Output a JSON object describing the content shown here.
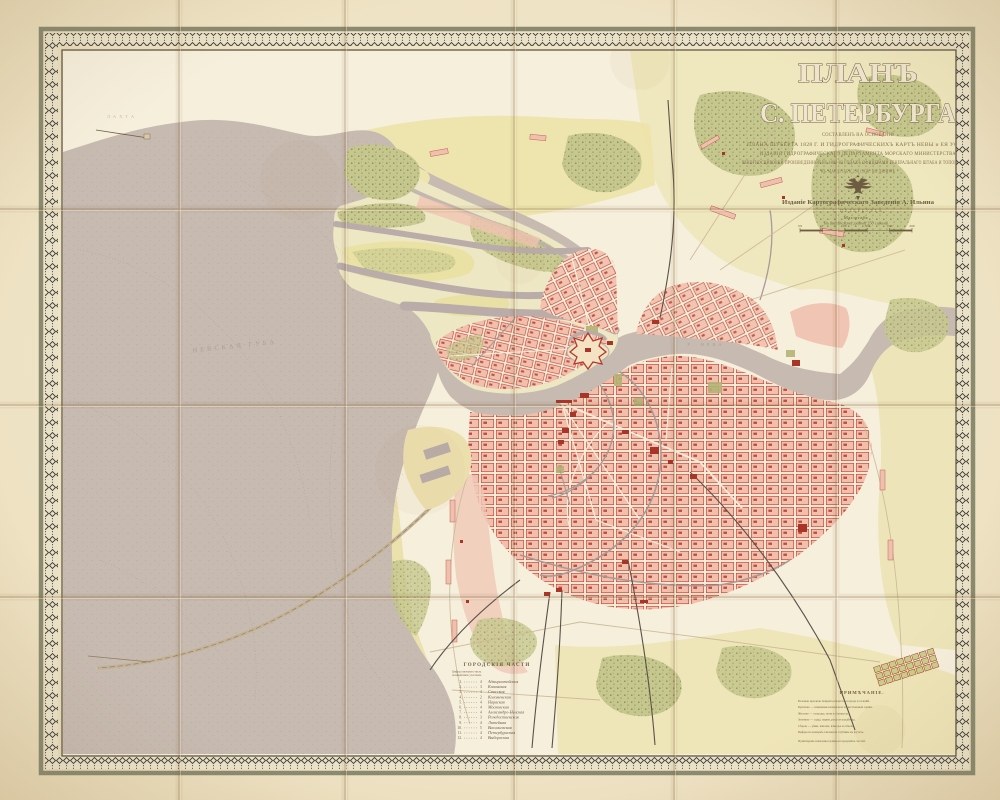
{
  "sheet": {
    "title_line1": "ПЛАНЪ",
    "title_line2": "С. ПЕТЕРБУРГА",
    "subtitle_lines": [
      "СОСТАВЛЕНЪ НА ОСНОВАНІИ",
      "ПЛАНА ШУБЕРТА 1828 Г. И ГИДРОГРАФИЧЕСКИХЪ КАРТЪ НЕВЫ и ЕЯ УСТЬЯ",
      "ИЗДАНІЯ ГИДРОГРАФИЧЕСКАГО ДЕПАРТАМЕНТА МОРСКАГО МИНИСТЕРСТВА",
      "РЕКОГНОСЦИРОВКИ ПРОИЗВЕДЕННОЙ ВЪ 1882-83 ГОДАХЪ ОФИЦЕРАМИ ГЕНЕРАЛЬНАГО ШТАБА И ТОПОГРАФАМИ",
      "ВЪ МАСШТАБѢ 250 САЖ. ВЪ ДЮЙМѢ"
    ],
    "publisher": "Изданіе Картографическаго Заведенія А. Ильина",
    "publisher_city": "С.ПЕТЕРБУРГЪ",
    "scale": {
      "label": "Масштабъ",
      "sublabel": "Въ англійскомъ дюймѣ 250 саженъ",
      "ticks": [
        "500",
        "0",
        "500",
        "1000",
        "1500",
        "2000"
      ]
    },
    "emblem_icon": "double-headed-eagle"
  },
  "map_labels": {
    "gulf": "НЕВСКАЯ ГУБА",
    "lakhta": "ЛАХТА",
    "neva": "Р. НЕВА"
  },
  "legend_districts": {
    "title": "ГОРОДСКІЯ ЧАСТИ",
    "note_line1": "Цифры означаютъ числа",
    "note_line2": "полицейскихъ участковъ",
    "items": [
      {
        "num": "1.",
        "count": "4",
        "name": "Адмиралтейская"
      },
      {
        "num": "2.",
        "count": "3",
        "name": "Казанская"
      },
      {
        "num": "3.",
        "count": "4",
        "name": "Спасская"
      },
      {
        "num": "4.",
        "count": "2",
        "name": "Коломенская"
      },
      {
        "num": "5.",
        "count": "4",
        "name": "Нарвская"
      },
      {
        "num": "6.",
        "count": "4",
        "name": "Московская"
      },
      {
        "num": "7.",
        "count": "4",
        "name": "Александро-Невская"
      },
      {
        "num": "8.",
        "count": "3",
        "name": "Рождественская"
      },
      {
        "num": "9.",
        "count": "4",
        "name": "Литейная"
      },
      {
        "num": "10.",
        "count": "5",
        "name": "Васильевская"
      },
      {
        "num": "11.",
        "count": "4",
        "name": "Петербургская"
      },
      {
        "num": "12.",
        "count": "4",
        "name": "Выборгская"
      }
    ]
  },
  "legend_notes": {
    "title": "ПРИМѢЧАНІЕ.",
    "lines": [
      "Розовою краскою покрыты кварталы города и селеній.",
      "Красною — каменныя казенныя и общественныя зданія.",
      "Желтою — огороды, поля и сѣнокосы.",
      "Зеленою — сады, парки, рощи и кладбища.",
      "Сѣрою — рѣки, каналы, взморье и отмели.",
      "Цифры на взморьѣ означаютъ глубины въ футахъ.",
      "Пунктиромъ показаны границы городскихъ частей."
    ]
  },
  "palette": {
    "paper": "#eee3c4",
    "map_ground": "#f6efdc",
    "water": "#c7bab0",
    "river": "#b7aaa7",
    "city_pink": "#f2bfac",
    "building_red": "#b03a2c",
    "field_yellow": "#ece3af",
    "wood_green": "#c6c78e",
    "frame_ink": "#3c3a33",
    "text_ink": "#6e5c40"
  }
}
